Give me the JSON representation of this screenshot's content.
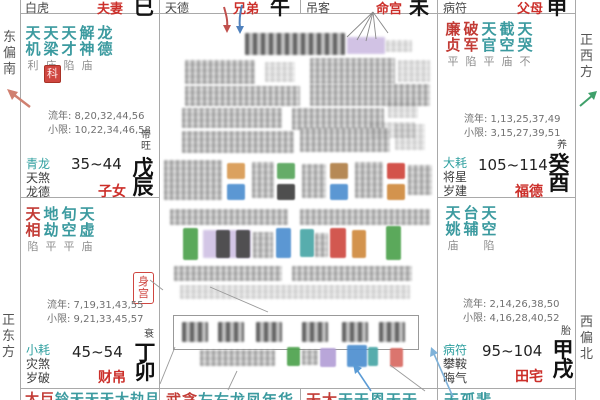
{
  "colors": {
    "star_minor_teal": "#3b9a9f",
    "star_major_red": "#c23b35",
    "palace_name_red": "#cc2f2a",
    "branch_black": "#141414",
    "hua_badge_red": "#cf4640",
    "annotation_red_arrow": "#c0504d",
    "annotation_blue_arrow": "#4f81bd",
    "compass_left_arrow": "#d08070",
    "compass_right_arrow": "#3fa06a",
    "highlight_purple": "#c9b8e0"
  },
  "compass": {
    "east_by_south": "东偏南",
    "due_east": "正东方",
    "due_west": "正西方",
    "west_by_north": "西偏北"
  },
  "top_row": [
    {
      "god": "白虎",
      "palace": "夫妻",
      "branch": "巳"
    },
    {
      "god": "天德",
      "palace": "兄弟",
      "branch": "午"
    },
    {
      "god": "吊客",
      "palace": "命宫",
      "branch": "未"
    },
    {
      "god": "病符",
      "palace": "父母",
      "branch": "申"
    }
  ],
  "palace_zinv": {
    "stars": [
      {
        "n": "天机",
        "b": "利"
      },
      {
        "n": "天梁",
        "b": "庙"
      },
      {
        "n": "天才",
        "b": "陷"
      },
      {
        "n": "解神",
        "b": "庙"
      },
      {
        "n": "龙德",
        "b": ""
      }
    ],
    "hua": "科",
    "liunian": "流年: 8,20,32,44,56",
    "xiaoxian": "小限: 10,22,34,46,58",
    "gods": [
      "青龙",
      "天煞",
      "龙德"
    ],
    "age": "35~44",
    "palace": "子女",
    "stage": "帝旺",
    "ganzhi": "戊辰"
  },
  "palace_caibo": {
    "stars": [
      {
        "n": "天相",
        "b": "陷"
      },
      {
        "n": "地劫",
        "b": "平"
      },
      {
        "n": "旬空",
        "b": "平"
      },
      {
        "n": "天虚",
        "b": "庙"
      }
    ],
    "body_badge": "身宫",
    "liunian": "流年: 7,19,31,43,55",
    "xiaoxian": "小限: 9,21,33,45,57",
    "gods": [
      "小耗",
      "灾煞",
      "岁破"
    ],
    "age": "45~54",
    "palace": "财帛",
    "stage": "衰",
    "ganzhi": "丁卯"
  },
  "palace_fude": {
    "stars": [
      {
        "n": "廉贞",
        "b": "平"
      },
      {
        "n": "破军",
        "b": "陷"
      },
      {
        "n": "天官",
        "b": "平"
      },
      {
        "n": "截空",
        "b": "庙"
      },
      {
        "n": "天哭",
        "b": "不"
      }
    ],
    "liunian": "流年: 1,13,25,37,49",
    "xiaoxian": "小限: 3,15,27,39,51",
    "gods": [
      "大耗",
      "将星",
      "岁建"
    ],
    "age": "105~114",
    "palace": "福德",
    "stage": "养",
    "ganzhi": "癸酉"
  },
  "palace_tianzhai": {
    "stars": [
      {
        "n": "天姚",
        "b": "庙"
      },
      {
        "n": "台辅",
        "b": ""
      },
      {
        "n": "天空",
        "b": "陷"
      }
    ],
    "liunian": "流年: 2,14,26,38,50",
    "xiaoxian": "小限: 4,16,28,40,52",
    "gods": [
      "病符",
      "攀鞍",
      "晦气"
    ],
    "age": "95~104",
    "palace": "田宅",
    "stage": "胎",
    "ganzhi": "甲戌"
  },
  "bottom_row": [
    {
      "lead": "太巨",
      "rest": "铃天天天大劫月"
    },
    {
      "lead": "武贪",
      "rest": "左右龙凤年华"
    },
    {
      "lead": "天太",
      "rest": "天天恩天天"
    },
    {
      "lead": "",
      "rest": "天孤蜚"
    }
  ]
}
